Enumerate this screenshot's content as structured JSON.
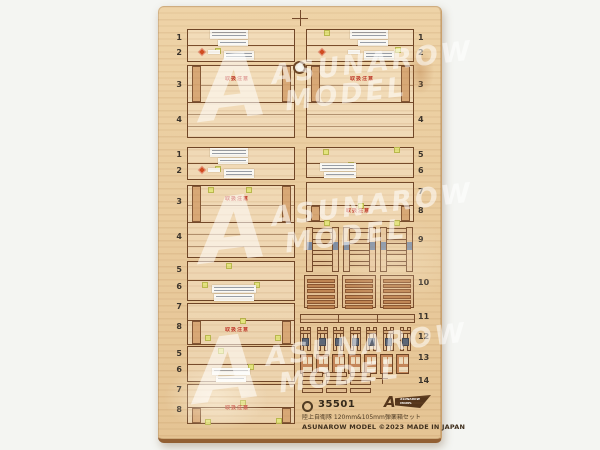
{
  "product": {
    "item_number": "35501",
    "title_jp": "陸上自衛隊 120mm&105mm弾薬箱セット",
    "credit_line": "ASUNAROW MODEL ©2023 MADE IN JAPAN"
  },
  "watermark": {
    "initial": "A",
    "line1": "ASUNAROW",
    "line2": "MODEL"
  },
  "logo_badge": {
    "initial": "A",
    "line1": "ASUNAROW",
    "line2": "MODEL"
  },
  "stencil_caution": "取扱注意",
  "part_numbers": {
    "left": [
      "1",
      "2",
      "3",
      "4",
      "1",
      "2",
      "3",
      "4",
      "5",
      "6",
      "7",
      "8",
      "5",
      "6",
      "7",
      "8"
    ],
    "right": [
      "1",
      "2",
      "3",
      "4",
      "5",
      "6",
      "7",
      "8",
      "9",
      "10",
      "11",
      "12",
      "13",
      "14"
    ]
  },
  "colors": {
    "background": "#f4f5f2",
    "wood": "#ebcfa2",
    "outline": "#6f4526",
    "stencil_red": "#c0392b",
    "tab_yellow": "#e3e47e",
    "label_white": "#f9f8f4"
  }
}
